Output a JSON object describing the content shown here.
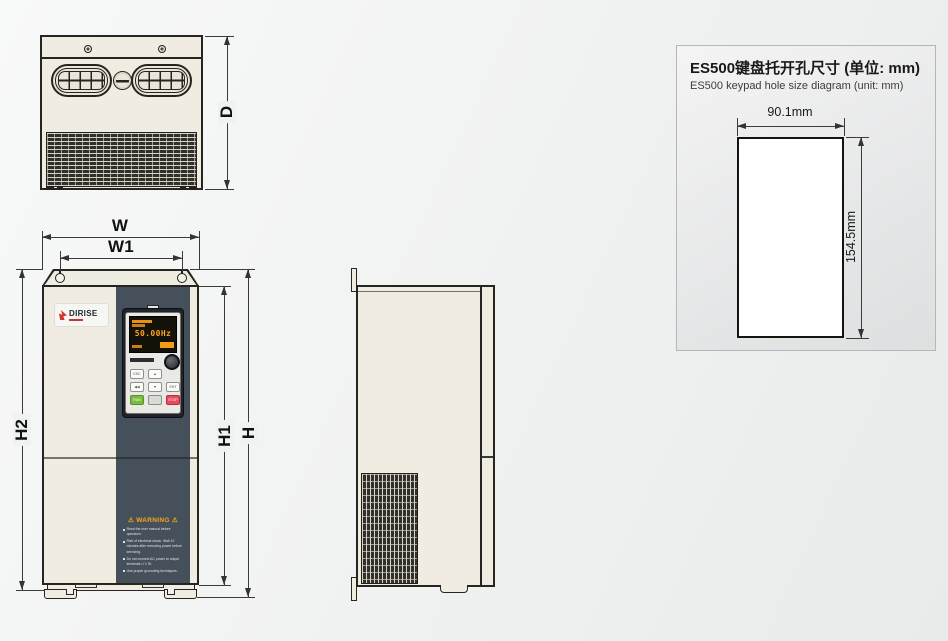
{
  "top_view": {
    "dim_d": "D"
  },
  "front_view": {
    "dim_w": "W",
    "dim_w1": "W1",
    "dim_h2": "H2",
    "dim_h1": "H1",
    "dim_h": "H",
    "logo": {
      "text": "DIRISE"
    },
    "keypad": {
      "display_value": "50.00Hz",
      "buttons": {
        "esc": "ESC",
        "up": "▲",
        "shift": "◀◀",
        "down": "▼",
        "enter": "ENT",
        "run": "RUN",
        "mode": "",
        "stop": "STOP"
      }
    },
    "warning": {
      "title": "⚠ WARNING ⚠",
      "lines": [
        "Read the user manual before operation.",
        "Risk of electrical shock. Wait 10 minutes after removing power before servicing.",
        "Do not connect AC power to output terminals U V W.",
        "Use proper grounding techniques."
      ]
    }
  },
  "keypad_panel": {
    "title_zh": "ES500键盘托开孔尺寸 (单位: mm)",
    "title_en": "ES500 keypad hole size diagram (unit: mm)",
    "dim_width": "90.1mm",
    "dim_height": "154.5mm"
  },
  "colors": {
    "body_cream": "#f0ece2",
    "panel_slate": "#45505a",
    "logo_red": "#d5352b",
    "display_orange": "#ffa41f",
    "run_green": "#7cb93f",
    "stop_red": "#e64a5c"
  }
}
